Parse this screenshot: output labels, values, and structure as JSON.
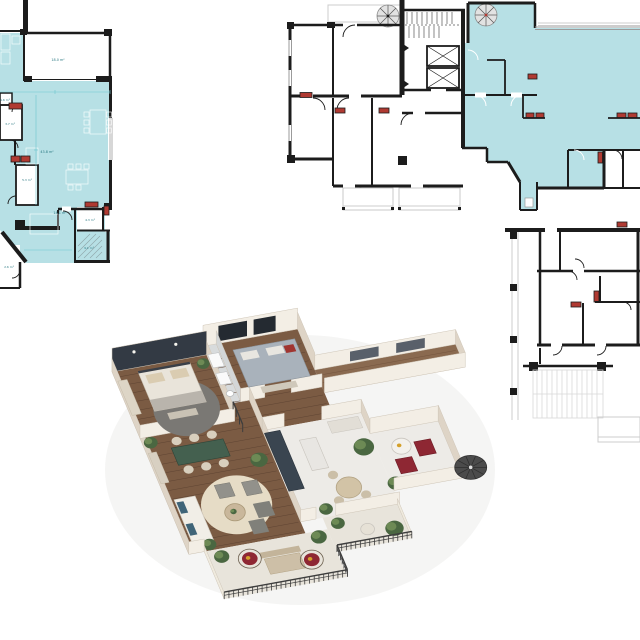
{
  "palette": {
    "teal": "#b7e0e5",
    "wall": "#1c1c1c",
    "radiator": "#b03a32",
    "dim": "#6ec6cf",
    "label": "#2e7b84",
    "wood": "#7b5b43",
    "wood_line": "#5f4433",
    "marble": "#edebe7",
    "bath_floor": "#d8dbdc",
    "balcony_floor": "#e8e4db",
    "wall_front": "#f3eee5",
    "wall_side": "#ded4c6",
    "accent_wall": "#333a44",
    "window_dark": "#242a31",
    "rail_metal": "#3d3d3d",
    "bed_linen": "#e9e4da",
    "pillow_beige": "#daccb1",
    "bed_gray": "#a9b2bb",
    "armchair_red": "#8e2733",
    "pillow_red": "#a03530",
    "pillow_blue": "#3f6478",
    "table_green": "#44604f",
    "chair_beige": "#d8cfbd",
    "rug_gray": "#7a7874",
    "rug_beige": "#e6dcc6",
    "sofa_white": "#f1eee7",
    "armchair_gray": "#92918b",
    "kitchen_dark": "#3a4550",
    "plant_green": "#4a6741",
    "plant_light": "#6d8a55",
    "accent_yellow": "#d4a02a",
    "stair_gray": "#4b4b4b"
  },
  "plan_left": {
    "rooms": [
      {
        "label": "18.0 m²"
      },
      {
        "label": "43.8 m²"
      },
      {
        "label": "14.1 m²"
      },
      {
        "label": "5.3 m²"
      },
      {
        "label": "4.3 m²"
      },
      {
        "label": "9.1 m²"
      },
      {
        "label": "3.7 m²"
      },
      {
        "label": "2.6 m²"
      },
      {
        "label": "1.6 m²"
      }
    ]
  },
  "render_3d": {
    "items": [
      "master-bed",
      "wardrobe",
      "round-rug",
      "dining-table",
      "dining-chair",
      "sideboard",
      "sofa",
      "armchair",
      "ottoman",
      "coffee-table",
      "kitchen-cabinets",
      "kitchen-island",
      "breakfast-table",
      "breakfast-chair",
      "guest-bed",
      "bathroom-fixture",
      "red-armchair",
      "side-table",
      "spiral-staircase",
      "balcony-railing",
      "outdoor-table",
      "hanging-chair",
      "plant"
    ]
  }
}
